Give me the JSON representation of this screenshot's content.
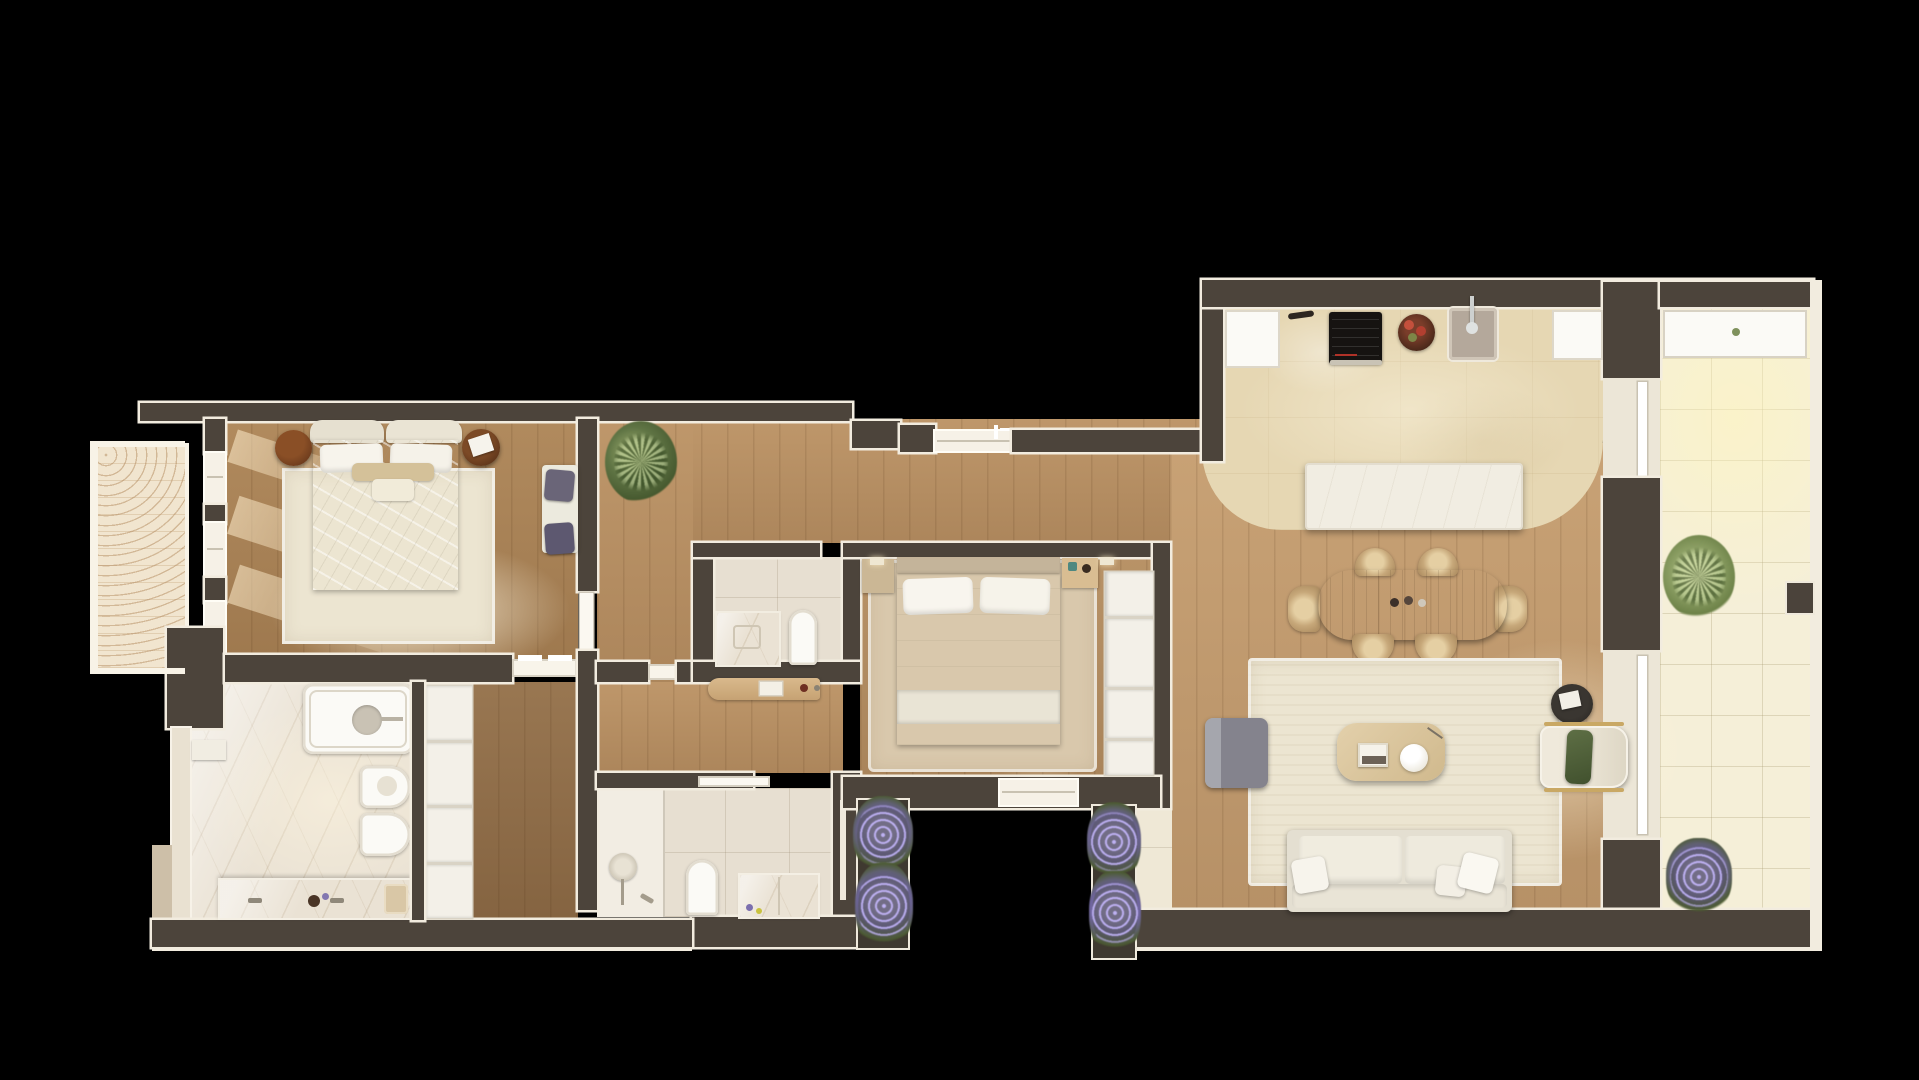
{
  "image_type": "rendered-top-down-apartment-floor-plan",
  "palette": {
    "bg": "#000000",
    "wall": "#4c443b",
    "wallLight": "#e9e1d1",
    "trim": "#f2ecdf",
    "woodBedroom": "#a88053",
    "woodHall": "#b78e61",
    "woodDressing": "#8d6a45",
    "woodLiving": "#c29a6d",
    "woodBed2": "#b18a5e",
    "travertine": "#e6d7b3",
    "terrace": "#f5efd8",
    "marble": "#eae2d4",
    "tileBath": "#e7dfd1",
    "rugCream": "#ece5d1",
    "rugTan": "#d9c8ac",
    "fabricWhite": "#f0ece1",
    "pillowPurple": "#68637a",
    "cushionGreen": "#55663f",
    "plantGreen": "#6f8355",
    "lavender": "#8377b0",
    "tableWood": "#a8906f",
    "ottomanGray": "#8f8e96",
    "hobBlack": "#161311",
    "sinkGray": "#b4a89b",
    "islandWhite": "#f1ede2"
  },
  "rooms": [
    {
      "id": "master-bedroom",
      "floor": "wood",
      "furniture": [
        "double-bed",
        "two-round-nightstands",
        "bench-with-purple-pillows",
        "cream-rug"
      ]
    },
    {
      "id": "west-balcony",
      "floor": "ornate-carpet",
      "furniture": []
    },
    {
      "id": "ensuite-bathroom",
      "floor": "marble",
      "furniture": [
        "bathtub",
        "bidet",
        "toilet",
        "double-vanity-counter"
      ]
    },
    {
      "id": "dressing-corridor",
      "floor": "wood",
      "furniture": [
        "wardrobe-column"
      ]
    },
    {
      "id": "hallway",
      "floor": "wood",
      "furniture": [
        "potted-plant",
        "console-desk"
      ]
    },
    {
      "id": "wc-laundry",
      "floor": "tile",
      "furniture": [
        "vanity",
        "toilet"
      ]
    },
    {
      "id": "second-bathroom",
      "floor": "tile",
      "furniture": [
        "walk-in-shower",
        "toilet",
        "vanity-chest",
        "towel-rail"
      ]
    },
    {
      "id": "second-bedroom",
      "floor": "wood",
      "furniture": [
        "double-bed",
        "tan-rug",
        "closet-column",
        "nightstand",
        "dresser"
      ]
    },
    {
      "id": "kitchen",
      "floor": "travertine",
      "furniture": [
        "counter-run",
        "induction-hob",
        "fruit-bowl",
        "sink",
        "island"
      ]
    },
    {
      "id": "living-dining",
      "floor": "wood",
      "furniture": [
        "dining-table",
        "six-wicker-chairs",
        "cream-rug",
        "sofa",
        "coffee-table",
        "ottoman",
        "armchair",
        "side-table"
      ]
    },
    {
      "id": "east-terrace",
      "floor": "pale-tile",
      "furniture": [
        "long-planter",
        "grass-plant",
        "lavender-pot",
        "ac-unit"
      ]
    },
    {
      "id": "south-planters",
      "floor": "none",
      "furniture": [
        "lavender-planter-west",
        "lavender-planter-east"
      ]
    }
  ]
}
